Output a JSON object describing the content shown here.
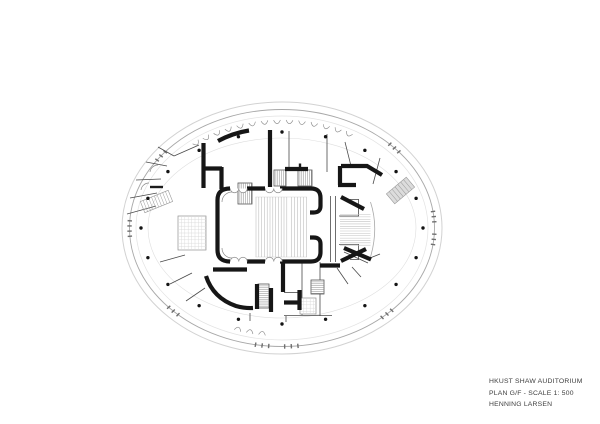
{
  "title_block": {
    "project": "HKUST SHAW AUDITORIUM",
    "drawing": "PLAN  G/F - SCALE 1: 500",
    "architect": "HENNING LARSEN"
  },
  "plan": {
    "center": {
      "x": 282,
      "y": 228
    },
    "colors": {
      "structural_wall": "#161616",
      "medium_wall": "#1c1c1c",
      "partition": "#4a4a4a",
      "door": "#8a8a8a",
      "seating_line": "#b9b9b9",
      "step_line": "#c2c2c2",
      "stair_stripe": "#8a8a8a",
      "stair_outline": "#555555",
      "grid_line": "#d9d9d9",
      "grid_outline": "#8f8f8f",
      "tick": "#6f6f6f",
      "column_dot": "#141414",
      "ramp_fill": "#dcdcdc",
      "ramp_stroke": "#9a9a9a",
      "stage_curve": "#a8a8a8",
      "seating_edge": "#d4d4d4"
    },
    "ellipses": [
      {
        "name": "canopy",
        "rx": 160,
        "ry": 126,
        "stroke": "#d2d2d2",
        "width": 1.0
      },
      {
        "name": "facade",
        "rx": 152.5,
        "ry": 118.5,
        "stroke": "#a8a8a8",
        "width": 0.9
      },
      {
        "name": "inner-facade",
        "rx": 146,
        "ry": 112,
        "stroke": "#e2e2e2",
        "width": 0.7
      },
      {
        "name": "lobby-wall",
        "rx": 134,
        "ry": 90,
        "stroke": "#dedede",
        "width": 0.6
      }
    ],
    "columns": {
      "count": 20,
      "rx": 141,
      "ry": 96,
      "dot_radius": 1.7,
      "start_angle": 0,
      "step": 18
    },
    "tick_ellipse": {
      "rx": 152.5,
      "ry": 118.5
    },
    "tick_clusters": [
      [
        -8,
        -5.5,
        -3
      ],
      [
        3,
        5.5,
        8
      ],
      [
        44,
        46.5,
        49
      ],
      [
        84,
        86.5,
        89
      ],
      [
        95,
        97.5,
        100
      ],
      [
        133,
        135.5,
        138
      ],
      [
        176,
        178.5,
        181,
        183.5
      ],
      [
        215,
        217.5,
        220
      ],
      [
        315,
        317.5,
        320
      ]
    ],
    "scallops": {
      "rx": 144,
      "ry": 108,
      "r": 3.4,
      "top_from": 233,
      "top_to": 298,
      "top_step": 5,
      "extra_angles": [
        98,
        103,
        108
      ]
    },
    "thick_walls": [
      "M 230 188.5 Q 217.5 188.5 217.5 200 V 250 Q 217.5 261.5 230 261.5",
      "M 247 188.5 H 265",
      "M 280 188.5 H 311 Q 320.5 188.5 320.5 198 V 206 Q 320.5 212.5 313.5 212.5 H 310",
      "M 247 261.5 H 265",
      "M 280 261.5 H 311 Q 320.5 261.5 320.5 252 V 244 Q 320.5 237.5 313.5 237.5 H 310",
      "M 218 141 Q 233 133 249 130.5",
      "M 203.5 143 V 188",
      "M 202 168.5 H 222",
      "M 221.5 167 V 189",
      "M 270 130 V 187",
      "M 285 169 H 308",
      "M 341 166 H 367 L 382 175",
      "M 340 166 V 185",
      "M 338 185 H 356",
      "M 341 197 L 364 209",
      "M 341 261 L 366 249",
      "M 344 248 L 371 259.5",
      "M 213 269.5 H 247",
      "M 206 276 Q 213 298 236 306 Q 245 308.5 253 308",
      "M 257 284 V 309",
      "M 271 288 V 312",
      "M 283 262 V 292",
      "M 299.5 290 V 310",
      "M 284 302.5 H 298",
      "M 320 265.5 H 340"
    ],
    "medium_walls": [
      "M 150 187 H 163",
      "M 300 163.5 V 169"
    ],
    "thin_walls": [
      "M 330.5 196 V 262",
      "M 335.5 196 V 262",
      "M 339 216 H 359",
      "M 358.5 199 V 216",
      "M 350 199.5 H 358.5",
      "M 339 244.5 H 359",
      "M 358.5 244 V 260",
      "M 350 259.5 H 358.5",
      "M 289 131 V 168",
      "M 327 134 V 172",
      "M 345 142 L 351 166",
      "M 380 158 L 373 184",
      "M 127 214 L 156 206",
      "M 130 198 L 157 193",
      "M 136 180 L 161 179",
      "M 146 162 L 167 166",
      "M 158 147 L 174 156",
      "M 174 156 L 199 145",
      "M 160 262 L 185 255",
      "M 170 284 L 192 273",
      "M 186 301 L 205 288",
      "M 302 262 V 315",
      "M 284 292.5 H 300",
      "M 284 315.5 H 332",
      "M 320 262 V 316",
      "M 250 313 V 321",
      "M 286 316 V 322",
      "M 337 268 L 348 284",
      "M 352 267 L 361 277",
      "M 344 252 L 368 263",
      "M 370 258 L 380 254"
    ],
    "door_arcs": [
      "M 232 192 A 10 10 0 0 0 222 202",
      "M 232 258 A 10 10 0 0 1 222 248",
      "M 150 172 A 8 8 0 0 1 158 165",
      "M 141 190 A 8 8 0 0 1 149 183"
    ],
    "hall_doors": {
      "xs": [
        234.5,
        243,
        269.5,
        278
      ],
      "top_y": 188.5,
      "bottom_y": 261.5,
      "r": 4.25
    },
    "seating": {
      "banks": [
        {
          "x0": 256,
          "x1": 287,
          "step": 2.8
        },
        {
          "x0": 291.5,
          "x1": 306.5,
          "step": 3.0
        }
      ],
      "y0": 197,
      "y1": 257,
      "edge_x0": 255.5,
      "edge_x1": 307
    },
    "stage_steps": {
      "x0": 340,
      "x1": 370.5,
      "y0": 214.5,
      "y1": 247.5,
      "step": 2.36
    },
    "stage_curve": "M 370.5 202 Q 379 228 370.5 257",
    "stairs": [
      {
        "x": 238,
        "y": 183,
        "w": 14,
        "h": 21,
        "dir": "v"
      },
      {
        "x": 274,
        "y": 170,
        "w": 12,
        "h": 16,
        "dir": "v"
      },
      {
        "x": 298,
        "y": 170,
        "w": 14,
        "h": 16,
        "dir": "v"
      },
      {
        "x": 258,
        "y": 284,
        "w": 11,
        "h": 24,
        "dir": "h"
      },
      {
        "x": 311,
        "y": 280,
        "w": 13,
        "h": 14,
        "dir": "h"
      }
    ],
    "grid_rooms": [
      {
        "x": 178,
        "y": 216,
        "w": 28,
        "h": 34
      },
      {
        "x": 300,
        "y": 298,
        "w": 16,
        "h": 16
      }
    ],
    "ramps": [
      {
        "cx": 156.5,
        "cy": 201.5,
        "w": 30,
        "h": 12,
        "angle": -22,
        "fill": "none",
        "stripes": 9
      },
      {
        "cx": 400.5,
        "cy": 190.5,
        "w": 26,
        "h": 13,
        "angle": -40,
        "fill": "#dcdcdc",
        "stripes": 6
      }
    ]
  }
}
